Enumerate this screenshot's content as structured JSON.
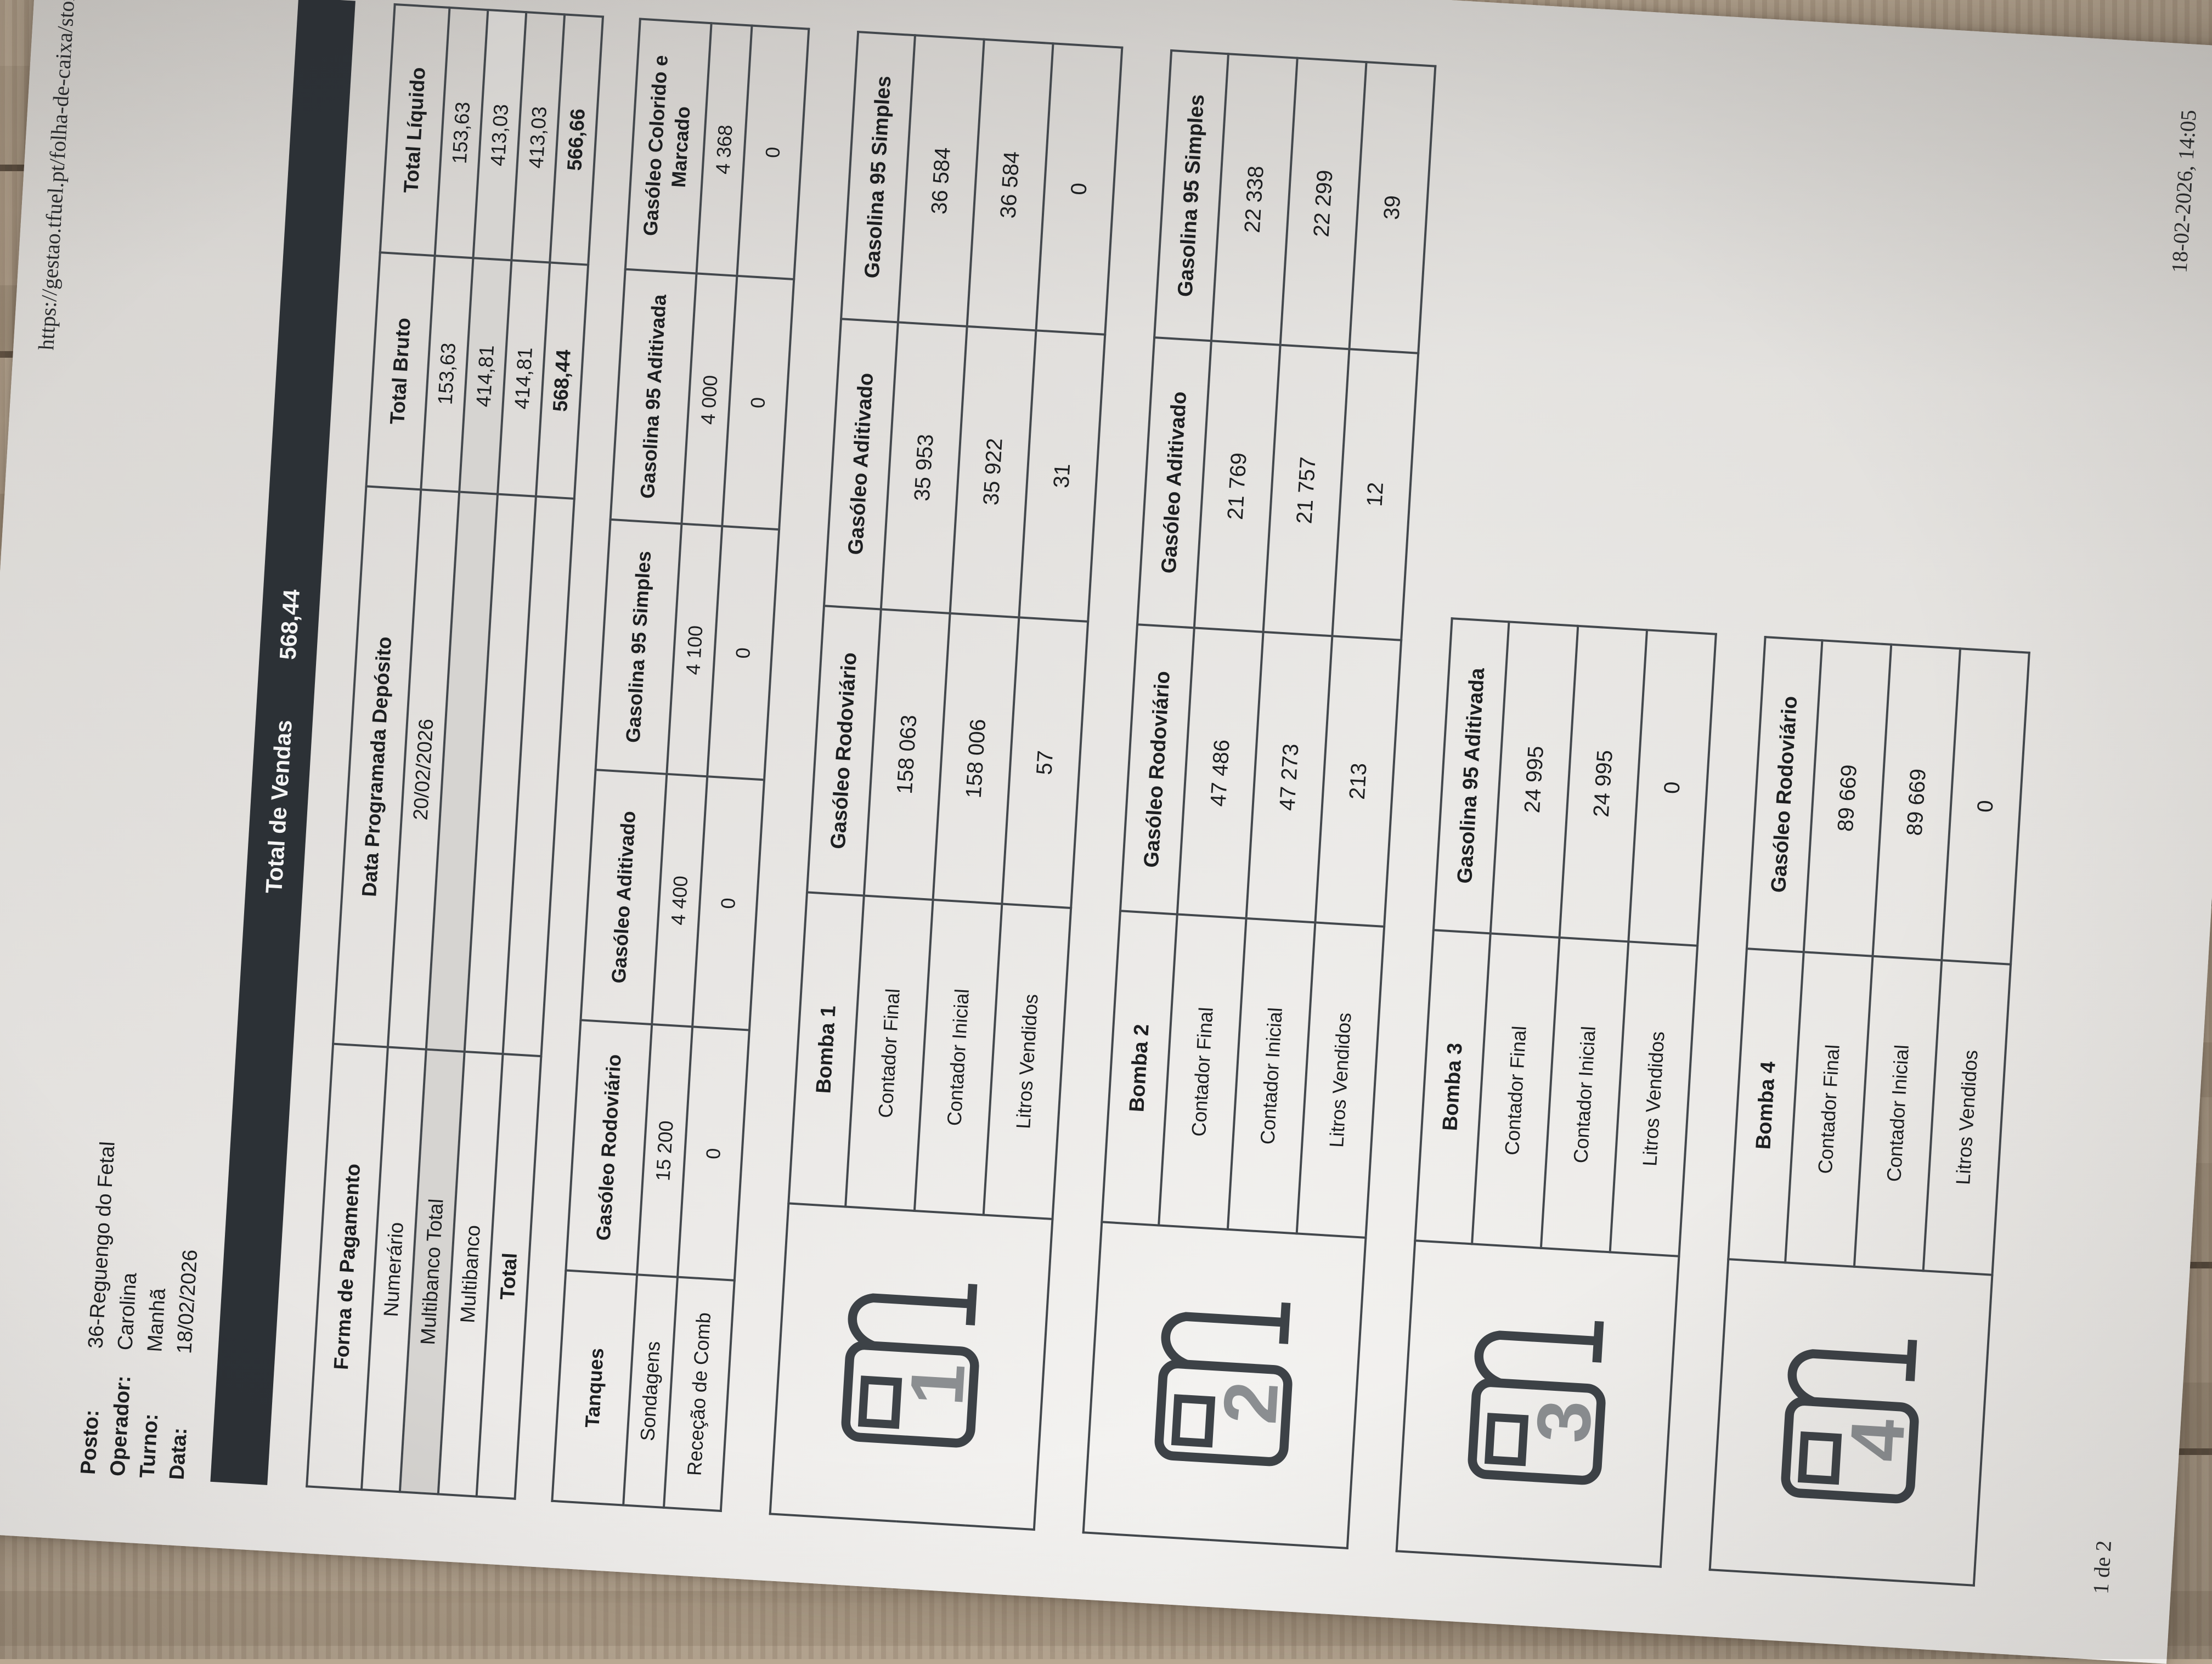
{
  "print_header": {
    "title": "Folha de Caixa",
    "url": "https://gestao.tfuel.pt/folha-de-caixa/store"
  },
  "print_footer": {
    "page": "1 de 2",
    "datetime": "18-02-2026, 14:05"
  },
  "info": {
    "posto_label": "Posto:",
    "posto": "36-Reguengo do Fetal",
    "operador_label": "Operador:",
    "operador": "Carolina",
    "turno_label": "Turno:",
    "turno": "Manhã",
    "data_label": "Data:",
    "data": "18/02/2026"
  },
  "total_bar": {
    "label": "Total de Vendas",
    "value": "568,44"
  },
  "payment": {
    "headers": [
      "Forma de Pagamento",
      "Data Programada Depósito",
      "Total Bruto",
      "Total Líquido"
    ],
    "rows": [
      [
        "Numerário",
        "20/02/2026",
        "153,63",
        "153,63"
      ],
      [
        "Multibanco Total",
        "",
        "414,81",
        "413,03"
      ],
      [
        "Multibanco",
        "",
        "414,81",
        "413,03"
      ],
      [
        "Total",
        "",
        "568,44",
        "566,66"
      ]
    ]
  },
  "tanks": {
    "corner": "Tanques",
    "fuels": [
      "Gasóleo Rodoviário",
      "Gasóleo Aditivado",
      "Gasolina 95 Simples",
      "Gasolina 95 Aditivada",
      "Gasóleo Colorido e Marcado"
    ],
    "rows": [
      {
        "label": "Sondagens",
        "values": [
          "15 200",
          "4 400",
          "4 100",
          "4 000",
          "4 368"
        ]
      },
      {
        "label": "Receção de Comb",
        "values": [
          "0",
          "0",
          "0",
          "0",
          "0"
        ]
      }
    ]
  },
  "pump_row_labels": [
    "Contador Final",
    "Contador Inicial",
    "Litros Vendidos"
  ],
  "pumps": [
    {
      "name": "Bomba 1",
      "number": "1",
      "fuels": [
        "Gasóleo Rodoviário",
        "Gasóleo Aditivado",
        "Gasolina 95 Simples"
      ],
      "rows": [
        [
          "158 063",
          "35 953",
          "36 584"
        ],
        [
          "158 006",
          "35 922",
          "36 584"
        ],
        [
          "57",
          "31",
          "0"
        ]
      ]
    },
    {
      "name": "Bomba 2",
      "number": "2",
      "fuels": [
        "Gasóleo Rodoviário",
        "Gasóleo Aditivado",
        "Gasolina 95 Simples"
      ],
      "rows": [
        [
          "47 486",
          "21 769",
          "22 338"
        ],
        [
          "47 273",
          "21 757",
          "22 299"
        ],
        [
          "213",
          "12",
          "39"
        ]
      ]
    },
    {
      "name": "Bomba 3",
      "number": "3",
      "fuels": [
        "Gasolina 95 Aditivada"
      ],
      "rows": [
        [
          "24 995"
        ],
        [
          "24 995"
        ],
        [
          "0"
        ]
      ]
    },
    {
      "name": "Bomba 4",
      "number": "4",
      "fuels": [
        "Gasóleo Rodoviário"
      ],
      "rows": [
        [
          "89 669"
        ],
        [
          "89 669"
        ],
        [
          "0"
        ]
      ]
    }
  ],
  "colors": {
    "bar": "#2c3136",
    "shaded_row": "#d6d4d1",
    "paper": "#f3f2f0"
  }
}
